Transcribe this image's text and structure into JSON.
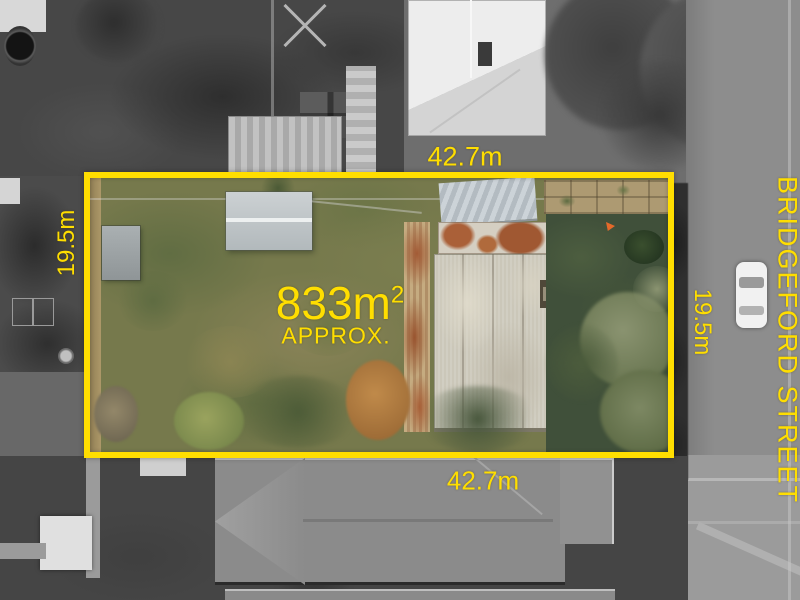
{
  "annotations": {
    "top_width": "42.7m",
    "bottom_width": "42.7m",
    "left_depth": "19.5m",
    "right_depth": "19.5m",
    "area_value": "833m",
    "area_superscript": "2",
    "area_qualifier": "APPROX.",
    "street_name": "BRIDGEFORD STREET"
  },
  "colors": {
    "boundary": "#FFDE00",
    "labels": "#FFDE00"
  }
}
